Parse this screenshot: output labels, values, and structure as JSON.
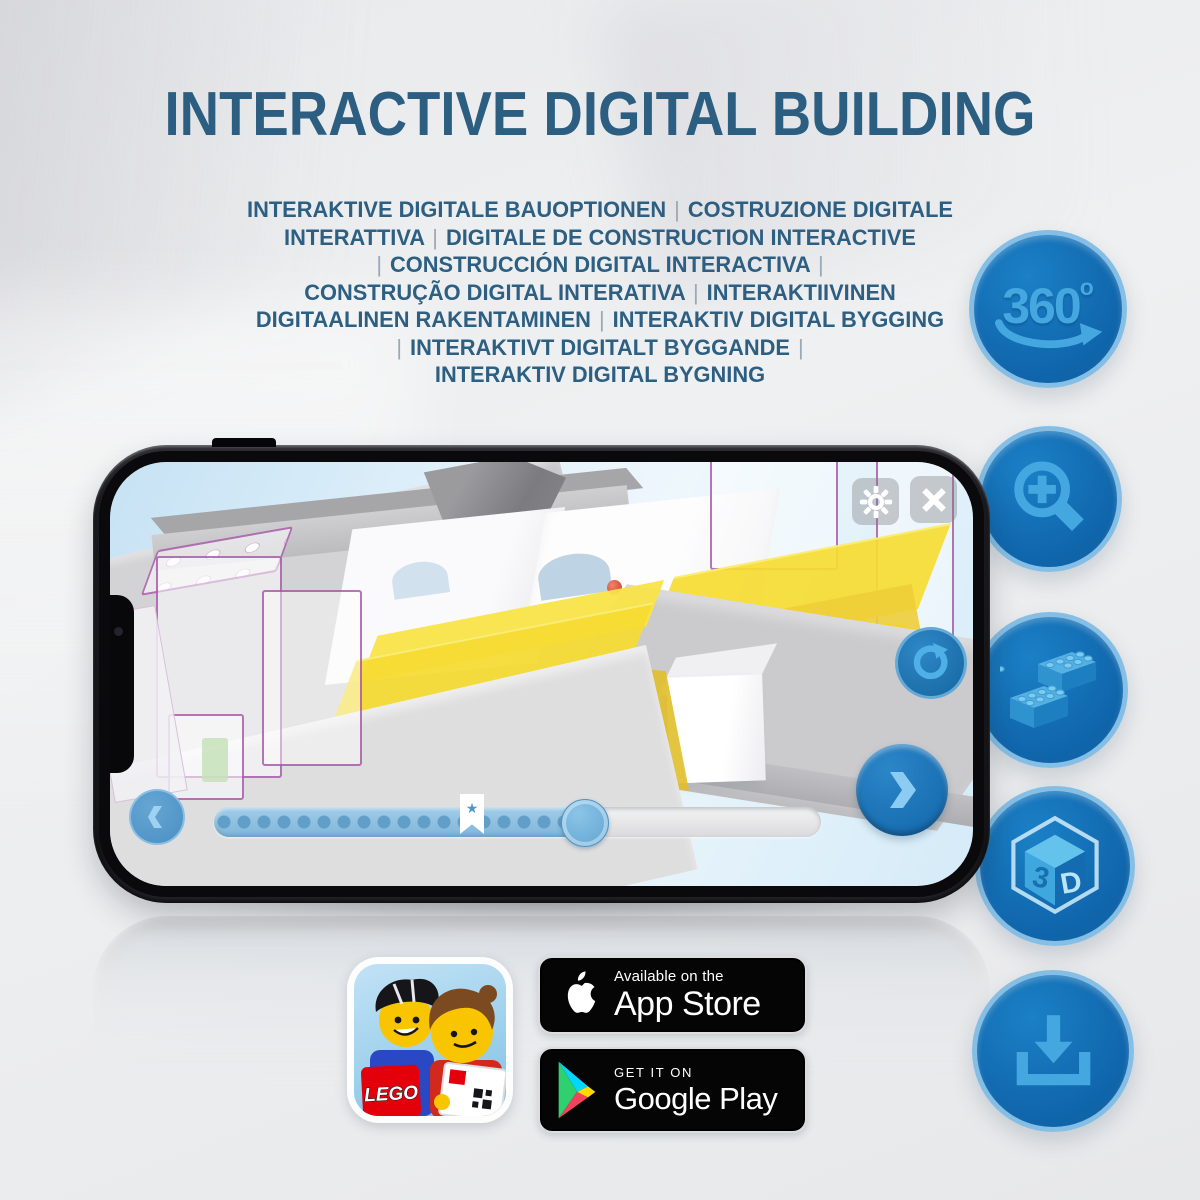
{
  "header": {
    "title": "INTERACTIVE DIGITAL BUILDING",
    "subtitle_lines": [
      "INTERAKTIVE DIGITALE BAUOPTIONEN | COSTRUZIONE DIGITALE",
      "INTERATTIVA | DIGITALE DE CONSTRUCTION INTERACTIVE",
      "| CONSTRUCCIÓN DIGITAL INTERACTIVA |",
      "CONSTRUÇÃO DIGITAL INTERATIVA | INTERAKTIIVINEN",
      "DIGITAALINEN RAKENTAMINEN | INTERAKTIV DIGITAL BYGGING",
      "| INTERAKTIVT DIGITALT BYGGANDE |",
      "INTERAKTIV DIGITAL BYGNING"
    ]
  },
  "feature_icons": {
    "rotate360": {
      "value": "360",
      "degree_mark": "o"
    },
    "cube3d": {
      "left_face": "3",
      "right_face": "D"
    }
  },
  "phone_app": {
    "viewer": {
      "progress_percent": 62,
      "bookmark_star": "★"
    }
  },
  "badges": {
    "app_store": {
      "tagline": "Available on the",
      "store_name": "App Store"
    },
    "google_play": {
      "tagline": "GET IT ON",
      "store_name": "Google Play"
    }
  },
  "app_icon": {
    "logo_text": "LEGO"
  },
  "colors": {
    "title_blue": "#2b5e80",
    "icon_circle_blue": "#1273ba",
    "icon_glyph_blue": "#45a7e0",
    "ui_button_blue": "#1b77c0",
    "badge_black": "#050505"
  }
}
